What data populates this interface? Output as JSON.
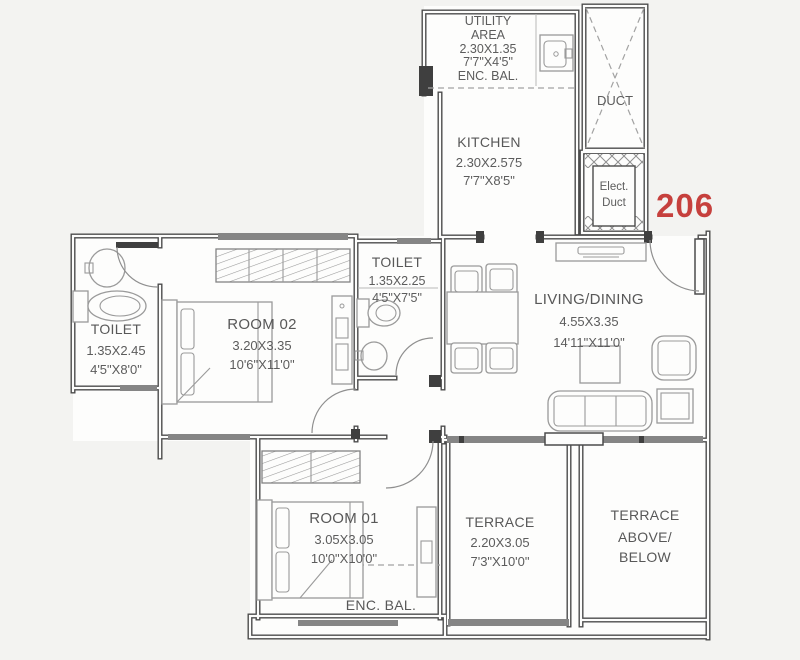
{
  "unit": {
    "number": "206"
  },
  "palette": {
    "unit_red": "#c6403d",
    "wall": "#4c4c4c",
    "label_text": "#585858",
    "furniture": "#9a9a9a",
    "background": "#f3f3f1",
    "floor": "#fdfdfc"
  },
  "rooms": {
    "utility": {
      "line1": "UTILITY",
      "line2": "AREA",
      "metric": "2.30X1.35",
      "imperial": "7'7\"X4'5\"",
      "note": "ENC. BAL."
    },
    "kitchen": {
      "name": "KITCHEN",
      "metric": "2.30X2.575",
      "imperial": "7'7\"X8'5\""
    },
    "duct": {
      "name": "DUCT"
    },
    "elect_duct": {
      "line1": "Elect.",
      "line2": "Duct"
    },
    "toilet_left": {
      "name": "TOILET",
      "metric": "1.35X2.45",
      "imperial": "4'5\"X8'0\""
    },
    "toilet_mid": {
      "name": "TOILET",
      "metric": "1.35X2.25",
      "imperial": "4'5\"X7'5\""
    },
    "room02": {
      "name": "ROOM 02",
      "metric": "3.20X3.35",
      "imperial": "10'6\"X11'0\""
    },
    "living": {
      "name": "LIVING/DINING",
      "metric": "4.55X3.35",
      "imperial": "14'11\"X11'0\""
    },
    "room01": {
      "name": "ROOM 01",
      "metric": "3.05X3.05",
      "imperial": "10'0\"X10'0\""
    },
    "enc_bal": {
      "name": "ENC. BAL."
    },
    "terrace": {
      "name": "TERRACE",
      "metric": "2.20X3.05",
      "imperial": "7'3\"X10'0\""
    },
    "terrace_above": {
      "line1": "TERRACE",
      "line2": "ABOVE/",
      "line3": "BELOW"
    }
  }
}
